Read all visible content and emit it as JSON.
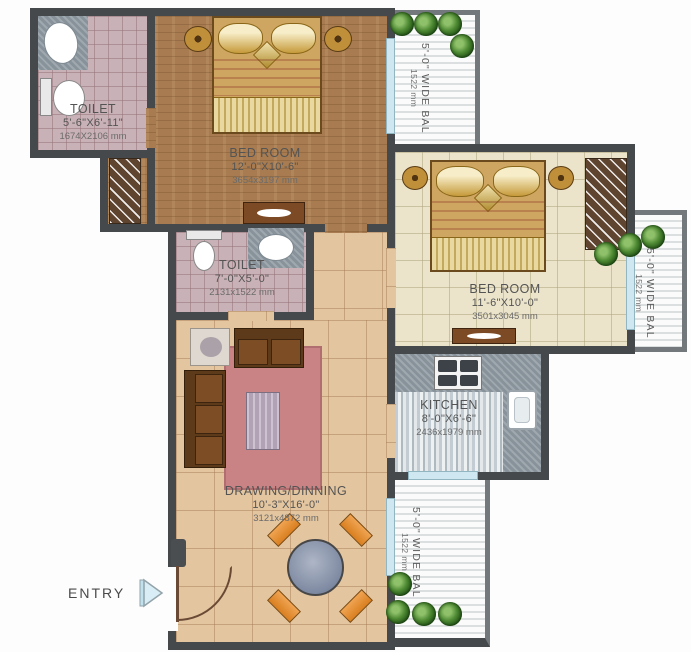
{
  "plan": {
    "entry": {
      "label": "ENTRY"
    },
    "rooms": [
      {
        "name": "TOILET",
        "dims_ft": "5'-6\"X6'-11\"",
        "dims_mm": "1674X2106 mm"
      },
      {
        "name": "BED ROOM",
        "dims_ft": "12'-0\"X10'-6\"",
        "dims_mm": "3654x3197 mm"
      },
      {
        "name": "TOILET",
        "dims_ft": "7'-0\"X5'-0\"",
        "dims_mm": "2131x1522 mm"
      },
      {
        "name": "BED ROOM",
        "dims_ft": "11'-6\"X10'-0\"",
        "dims_mm": "3501x3045 mm"
      },
      {
        "name": "KITCHEN",
        "dims_ft": "8'-0\"X6'-6\"",
        "dims_mm": "2436x1979 mm"
      },
      {
        "name": "DRAWING/DINNING",
        "dims_ft": "10'-3\"X16'-0\"",
        "dims_mm": "3121x4872 mm"
      }
    ],
    "balconies": [
      {
        "label": "5'-0\" WIDE BAL",
        "dims_mm": "1522 mm"
      },
      {
        "label": "5'-0\" WIDE BAL",
        "dims_mm": "1522 mm"
      },
      {
        "label": "5'-0\" WIDE BAL",
        "dims_mm": "1522 mm"
      }
    ],
    "palette": {
      "wall": "#45494c",
      "toilet_floor": "#c9b2b7",
      "bedroom1_floor": "#a87c50",
      "bedroom2_floor": "#ebe3ca",
      "living_floor": "#e3c59f",
      "rug": "#c98384",
      "kitchen_floor": "#c6ced4",
      "chair_accent": "#e68f37",
      "balcony_rail": "#72787b",
      "plant_green": "#4e8a33",
      "entry_arrow": "#d9edf6"
    }
  }
}
